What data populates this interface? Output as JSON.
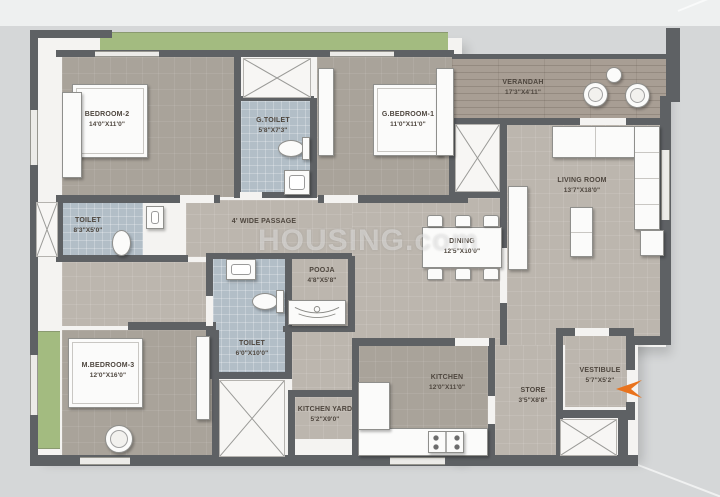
{
  "watermark": {
    "text": "HOUSING.com"
  },
  "colors": {
    "background": "#d5d7d8",
    "wall": "#5e6164",
    "room_floor": "#a9a39a",
    "open_floor": "#bcb6ae",
    "toilet_floor": "#b2bec7",
    "verandah_floor": "#a89e94",
    "green_strip": "#a3bb80",
    "entrance_arrow": "#e9731d",
    "label_text": "#4e463e"
  },
  "icons": {
    "entrance": "entrance-arrow-left",
    "shaft": "x-cross",
    "toilet": "wc",
    "washbasin": "basin",
    "cooktop": "stove-4-burner"
  },
  "rooms": {
    "bedroom2": {
      "name": "BEDROOM-2",
      "dims": "14'0\"X11'0\""
    },
    "g_toilet": {
      "name": "G.TOILET",
      "dims": "5'8\"X7'3\""
    },
    "g_bedroom1": {
      "name": "G.BEDROOM-1",
      "dims": "11'0\"X11'0\""
    },
    "verandah": {
      "name": "VERANDAH",
      "dims": "17'3\"X4'11\""
    },
    "living": {
      "name": "LIVING ROOM",
      "dims": "13'7\"X18'0\""
    },
    "toilet1": {
      "name": "TOILET",
      "dims": "8'3\"X5'0\""
    },
    "passage": {
      "name": "4' WIDE PASSAGE"
    },
    "dining": {
      "name": "DINING",
      "dims": "12'5\"X10'0\""
    },
    "pooja": {
      "name": "POOJA",
      "dims": "4'8\"X5'8\""
    },
    "toilet2": {
      "name": "TOILET",
      "dims": "6'0\"X10'0\""
    },
    "m_bedroom3": {
      "name": "M.BEDROOM-3",
      "dims": "12'0\"X16'0\""
    },
    "kitchen": {
      "name": "KITCHEN",
      "dims": "12'0\"X11'0\""
    },
    "kitchen_yard": {
      "name": "KITCHEN YARD",
      "dims": "5'2\"X9'0\""
    },
    "store": {
      "name": "STORE",
      "dims": "3'5\"X8'8\""
    },
    "vestibule": {
      "name": "VESTIBULE",
      "dims": "5'7\"X5'2\""
    }
  }
}
